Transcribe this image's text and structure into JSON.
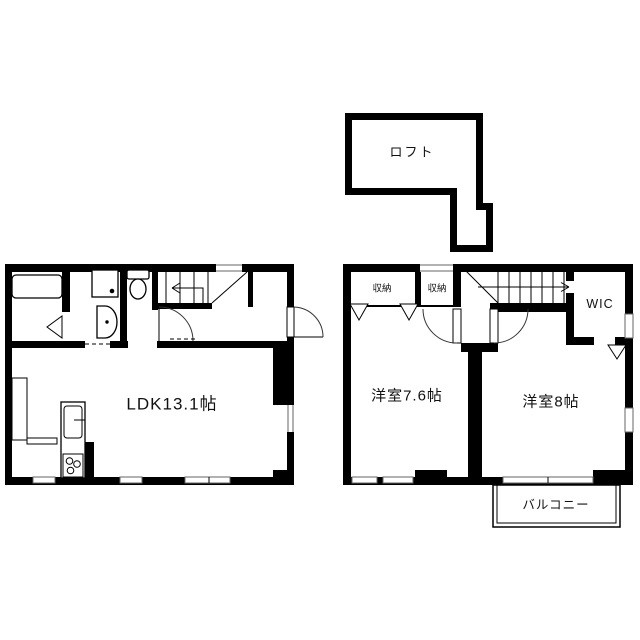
{
  "plan": {
    "loft": {
      "label": "ロフト"
    },
    "floor1": {
      "ldk_label": "LDK13.1帖"
    },
    "floor2": {
      "closet_left_label": "収納",
      "closet_right_label": "収納",
      "wic_label": "WIC",
      "bedroom_left_label": "洋室7.6帖",
      "bedroom_right_label": "洋室8帖",
      "balcony_label": "バルコニー"
    },
    "colors": {
      "wall": "#000000",
      "background": "#ffffff",
      "window_trim": "#666666"
    }
  }
}
